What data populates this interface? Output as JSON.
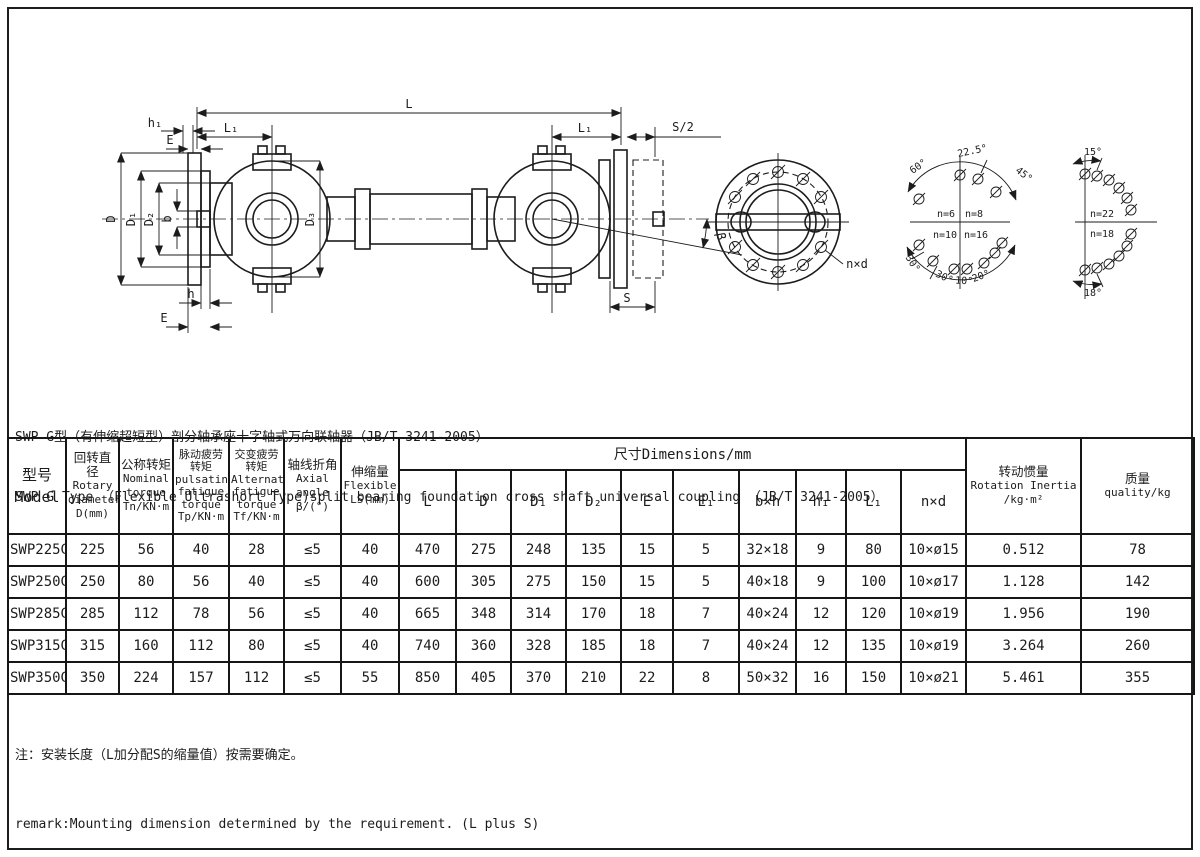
{
  "titles": {
    "zh": "SWP G型（有伸缩超短型）剖分轴承座十字轴式万向联轴器（JB/T 3241-2005）",
    "en": "SWP G Type （Flexible Ultrashort Type)split bearing foundation cross shaft universal coupling （JB/T 3241-2005）"
  },
  "diagram": {
    "labels": {
      "L": "L",
      "L1": "L₁",
      "S2": "S/2",
      "S": "S",
      "h1": "h₁",
      "h": "h",
      "E": "E",
      "b": "b",
      "D": "D",
      "D1": "D₁",
      "D2": "D₂",
      "D3": "D₃",
      "beta": "β",
      "nxd": "n×d",
      "deg60": "60°",
      "deg225": "22.5°",
      "deg45": "45°",
      "deg30a": "30°",
      "deg30b": "30°",
      "deg10": "10°",
      "deg20": "20°",
      "n6": "n=6",
      "n8": "n=8",
      "n10": "n=10",
      "n16": "n=16",
      "deg15": "15°",
      "deg18": "18°",
      "n22": "n=22",
      "n18": "n=18"
    }
  },
  "table": {
    "left_cols": [
      {
        "lines": [
          "型号",
          "Model"
        ]
      },
      {
        "lines": [
          "回转直径",
          "Rotary",
          "diameter",
          "D(mm)"
        ]
      },
      {
        "lines": [
          "公称转矩",
          "Nominal",
          "torque",
          "Tn/KN·m"
        ]
      },
      {
        "lines": [
          "脉动疲劳转矩",
          "pulsating",
          "fatigue",
          "torque",
          "Tp/KN·m"
        ]
      },
      {
        "lines": [
          "交变疲劳转矩",
          "Alternating",
          "fatigue",
          "torque",
          "Tf/KN·m"
        ]
      },
      {
        "lines": [
          "轴线折角",
          "Axial angle",
          "β/(°)"
        ]
      },
      {
        "lines": [
          "伸缩量",
          "Flexible",
          "LS(mm)"
        ]
      }
    ],
    "dim_group": {
      "title": "尺寸Dimensions/mm",
      "cols": [
        "L",
        "D",
        "D₁",
        "D₂",
        "E",
        "E₁",
        "b×h",
        "h₁",
        "L₁",
        "n×d"
      ]
    },
    "right_cols": [
      {
        "lines": [
          "转动惯量",
          "Rotation Inertia",
          "/kg·m²"
        ]
      },
      {
        "lines": [
          "质量",
          "quality/kg"
        ]
      }
    ],
    "rows": [
      {
        "model": "SWP225G",
        "values": [
          "225",
          "56",
          "40",
          "28",
          "≤5",
          "40",
          "470",
          "275",
          "248",
          "135",
          "15",
          "5",
          "32×18",
          "9",
          "80",
          "10×ø15",
          "0.512",
          "78"
        ]
      },
      {
        "model": "SWP250G",
        "values": [
          "250",
          "80",
          "56",
          "40",
          "≤5",
          "40",
          "600",
          "305",
          "275",
          "150",
          "15",
          "5",
          "40×18",
          "9",
          "100",
          "10×ø17",
          "1.128",
          "142"
        ]
      },
      {
        "model": "SWP285G",
        "values": [
          "285",
          "112",
          "78",
          "56",
          "≤5",
          "40",
          "665",
          "348",
          "314",
          "170",
          "18",
          "7",
          "40×24",
          "12",
          "120",
          "10×ø19",
          "1.956",
          "190"
        ]
      },
      {
        "model": "SWP315G",
        "values": [
          "315",
          "160",
          "112",
          "80",
          "≤5",
          "40",
          "740",
          "360",
          "328",
          "185",
          "18",
          "7",
          "40×24",
          "12",
          "135",
          "10×ø19",
          "3.264",
          "260"
        ]
      },
      {
        "model": "SWP350G",
        "values": [
          "350",
          "224",
          "157",
          "112",
          "≤5",
          "55",
          "850",
          "405",
          "370",
          "210",
          "22",
          "8",
          "50×32",
          "16",
          "150",
          "10×ø21",
          "5.461",
          "355"
        ]
      }
    ]
  },
  "notes": {
    "zh": "注：安装长度（L加分配S的缩量值）按需要确定。",
    "en": "remark:Mounting dimension determined by the requirement. (L plus S)"
  }
}
